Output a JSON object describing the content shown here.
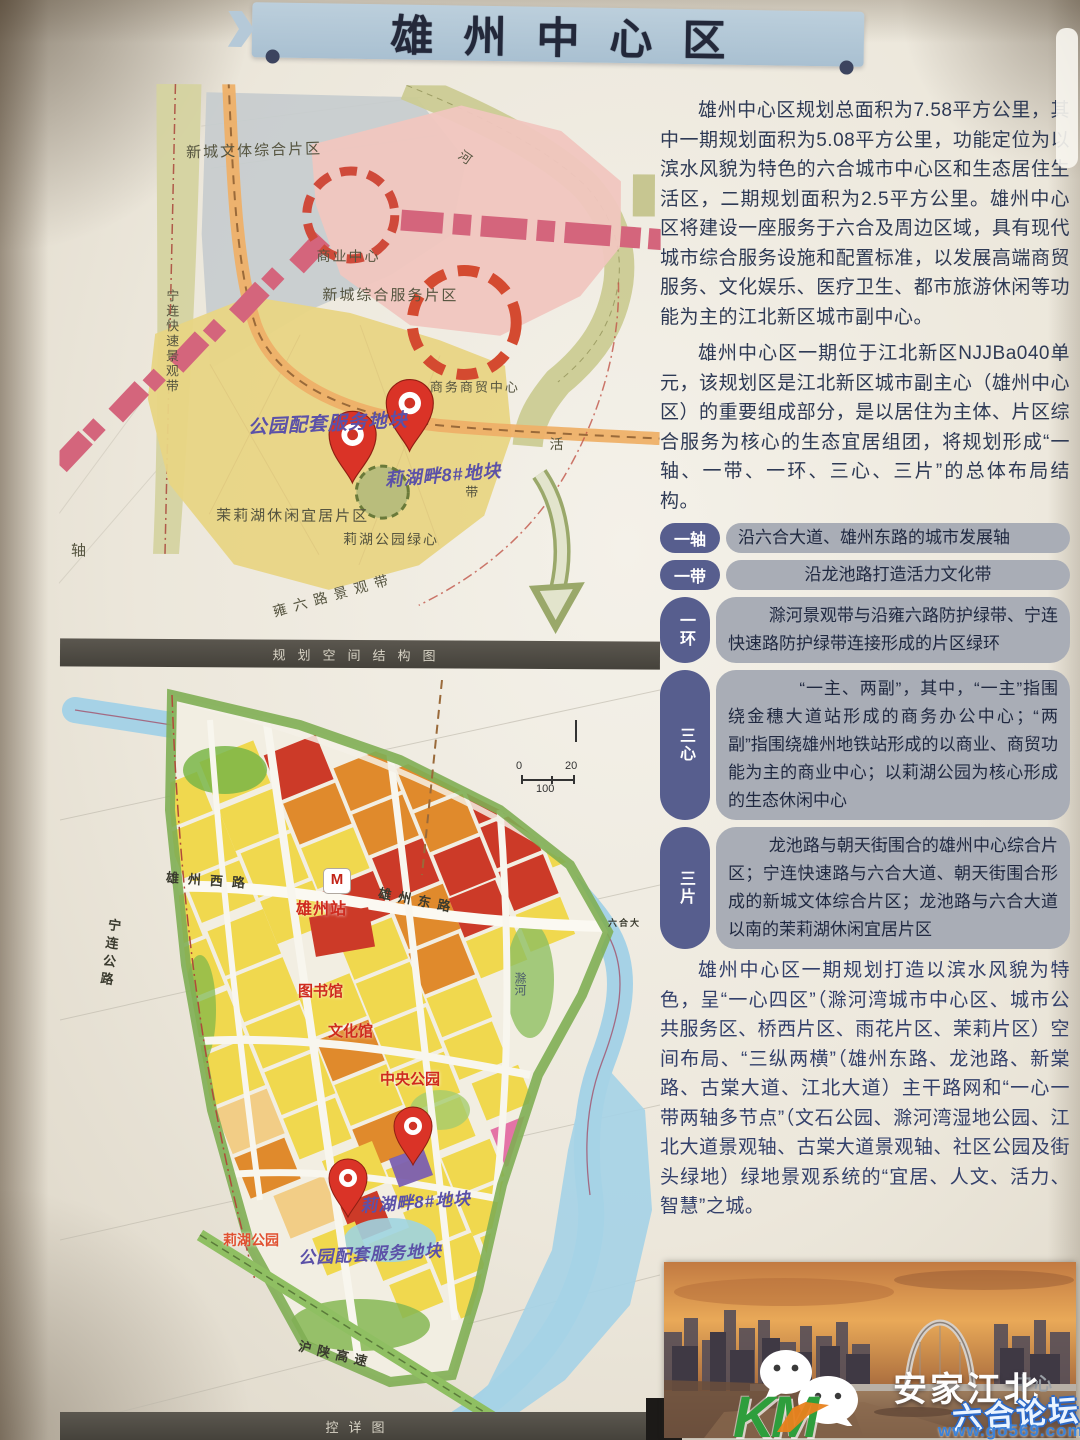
{
  "title": "雄州中心区",
  "intro": {
    "p1": "雄州中心区规划总面积为7.58平方公里，其中一期规划面积为5.08平方公里，功能定位为以滨水风貌为特色的六合城市中心区和生态居住生活区，二期规划面积为2.5平方公里。雄州中心区将建设一座服务于六合及周边区域，具有现代城市综合服务设施和配置标准，以发展高端商贸服务、文化娱乐、医疗卫生、都市旅游休闲等功能为主的江北新区城市副中心。",
    "p2": "雄州中心区一期位于江北新区NJJBa040单元，该规划区是江北新区城市副主心（雄州中心区）的重要组成部分，是以居住为主体、片区综合服务为核心的生态宜居组团，将规划形成“一轴、一带、一环、三心、三片”的总体布局结构。",
    "p3": "雄州中心区一期规划打造以滨水风貌为特色，呈“一心四区”（滁河湾城市中心区、城市公共服务区、桥西片区、雨花片区、茉莉片区）空间布局、“三纵两横”（雄州东路、龙池路、新棠路、古棠大道、江北大道）主干路网和“一心一带两轴多节点”（文石公园、滁河湾湿地公园、江北大道景观轴、古棠大道景观轴、社区公园及街头绿地）绿地景观系统的“宜居、人文、活力、智慧”之城。"
  },
  "structure_items": [
    {
      "label": "一轴",
      "text": "沿六合大道、雄州东路的城市发展轴"
    },
    {
      "label": "一带",
      "text": "沿龙池路打造活力文化带"
    },
    {
      "label": "一环",
      "text": "滁河景观带与沿雍六路防护绿带、宁连快速路防护绿带连接形成的片区绿环"
    },
    {
      "label": "三心",
      "text": "“一主、两副”，其中，“一主”指围绕金穗大道站形成的商务办公中心；“两副”指围绕雄州地铁站形成的以商业、商贸功能为主的商业中心；以莉湖公园为核心形成的生态休闲中心"
    },
    {
      "label": "三片",
      "text": "龙池路与朝天街围合的雄州中心综合片区；宁连快速路与六合大道、朝天街围合形成的新城文体综合片区；龙池路与六合大道以南的茉莉湖休闲宜居片区"
    }
  ],
  "map1": {
    "caption": "规划空间结构图",
    "labels": {
      "district_grey": "新城文体综合片区",
      "biz_center": "商业中心",
      "service_district": "新城综合服务片区",
      "trade_center": "商务商贸中心",
      "park_plot": "公园配套服务地块",
      "lakeside_plot": "莉湖畔8#地块",
      "moli_district": "茉莉湖休闲宜居片区",
      "green_core": "莉湖公园绿心",
      "expressway_belt": "宁连快速景观带",
      "yongliu_belt": "雍六路景观带",
      "axis": "轴",
      "river": "河",
      "huo": "活",
      "dai": "带"
    }
  },
  "map2": {
    "caption": "控详图",
    "labels": {
      "xiongzhou_west_rd": "雄州西路",
      "xiongzhou_station": "雄州站",
      "metro": "M",
      "xiongzhou_east_rd": "雄州东路",
      "liuhe_ave": "六合大",
      "ninglian_hwy": "宁连公路",
      "library": "图书馆",
      "culture_hall": "文化馆",
      "central_park": "中央公园",
      "lakeside_plot": "莉湖畔8#地块",
      "park_plot": "公园配套服务地块",
      "lihu_park": "莉湖公园",
      "hushan_expwy": "沪陕高速",
      "chu_river": "滁河"
    },
    "scale": {
      "zero": "0",
      "twenty": "20",
      "hundred": "100"
    }
  },
  "watermark": {
    "partial": "中心",
    "brand": "安家江北",
    "forum": "六合论坛",
    "url": "www.go569.com"
  }
}
